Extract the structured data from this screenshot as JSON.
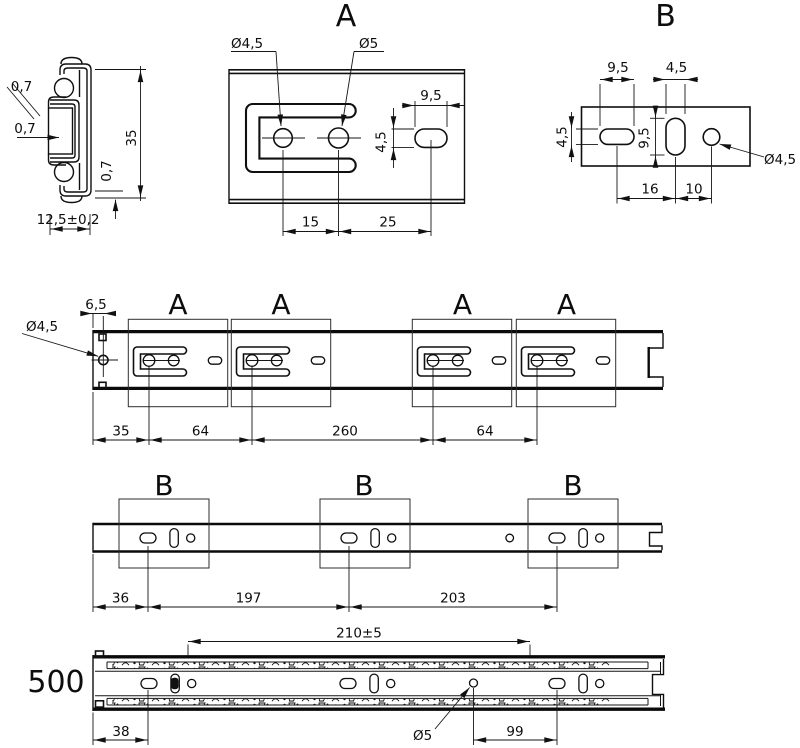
{
  "cross_section": {
    "wall_top": "0,7",
    "wall_web": "0,7",
    "wall_bottom": "0,7",
    "height": "35",
    "width": "12,5±0,2"
  },
  "detail_a": {
    "title": "A",
    "dia_small": "Ø4,5",
    "dia_large": "Ø5",
    "slot_length": "9,5",
    "slot_width": "4,5",
    "hole_spacing": "15",
    "slot_spacing": "25"
  },
  "detail_b": {
    "title": "B",
    "slot_length": "9,5",
    "vslot_width": "4,5",
    "slot_height": "4,5",
    "vslot_length": "9,5",
    "spacing_16": "16",
    "spacing_10": "10",
    "dia": "Ø4,5"
  },
  "rail_a": {
    "labels": [
      "A",
      "A",
      "A",
      "A"
    ],
    "dia_end": "Ø4,5",
    "edge_offset": "6,5",
    "spacings": [
      "35",
      "64",
      "260",
      "64"
    ]
  },
  "rail_b": {
    "labels": [
      "B",
      "B",
      "B"
    ],
    "spacings": [
      "36",
      "197",
      "203"
    ]
  },
  "assembly": {
    "length": "500",
    "dim_top": "210±5",
    "dim_front": "38",
    "dia_hole": "Ø5",
    "dim_99": "99"
  }
}
